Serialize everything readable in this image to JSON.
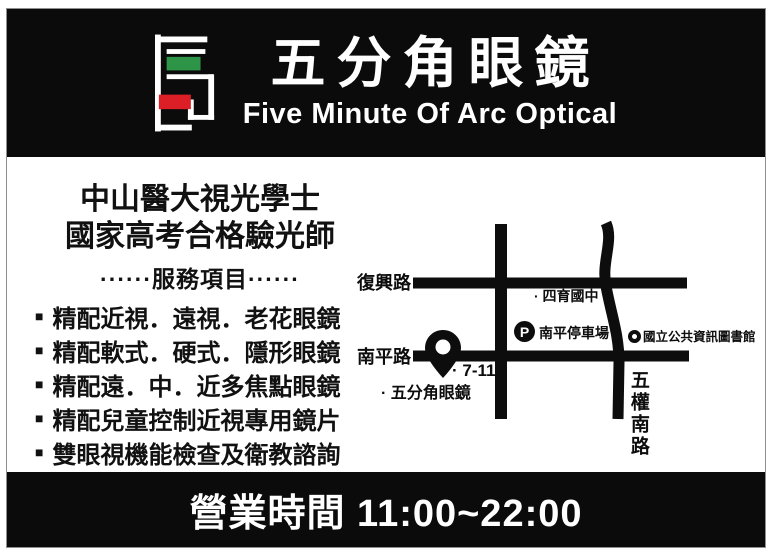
{
  "header": {
    "title": "五分角眼鏡",
    "subtitle": "Five Minute Of Arc Optical",
    "logo_colors": {
      "green": "#2e9548",
      "red": "#dc1f26",
      "outline": "#ffffff"
    }
  },
  "credentials": {
    "line1": "中山醫大視光學士",
    "line2": "國家高考合格驗光師"
  },
  "services": {
    "heading": "······服務項目······",
    "bullet": "■",
    "items": [
      "精配近視．遠視．老花眼鏡",
      "精配軟式．硬式．隱形眼鏡",
      "精配遠．中．近多焦點眼鏡",
      "精配兒童控制近視專用鏡片",
      "雙眼視機能檢查及衛教諮詢"
    ]
  },
  "map": {
    "road_labels": {
      "fuxing": "復興路",
      "nanping": "南平路",
      "wuquan": "五權南路"
    },
    "pois": {
      "school": "· 四育國中",
      "parking_icon": "P",
      "parking_label": "南平停車場",
      "library_label": "國立公共資訊圖書館",
      "seven_eleven": "· 7-11",
      "shop": "· 五分角眼鏡"
    }
  },
  "footer": {
    "hours": "營業時間 11:00~22:00"
  }
}
